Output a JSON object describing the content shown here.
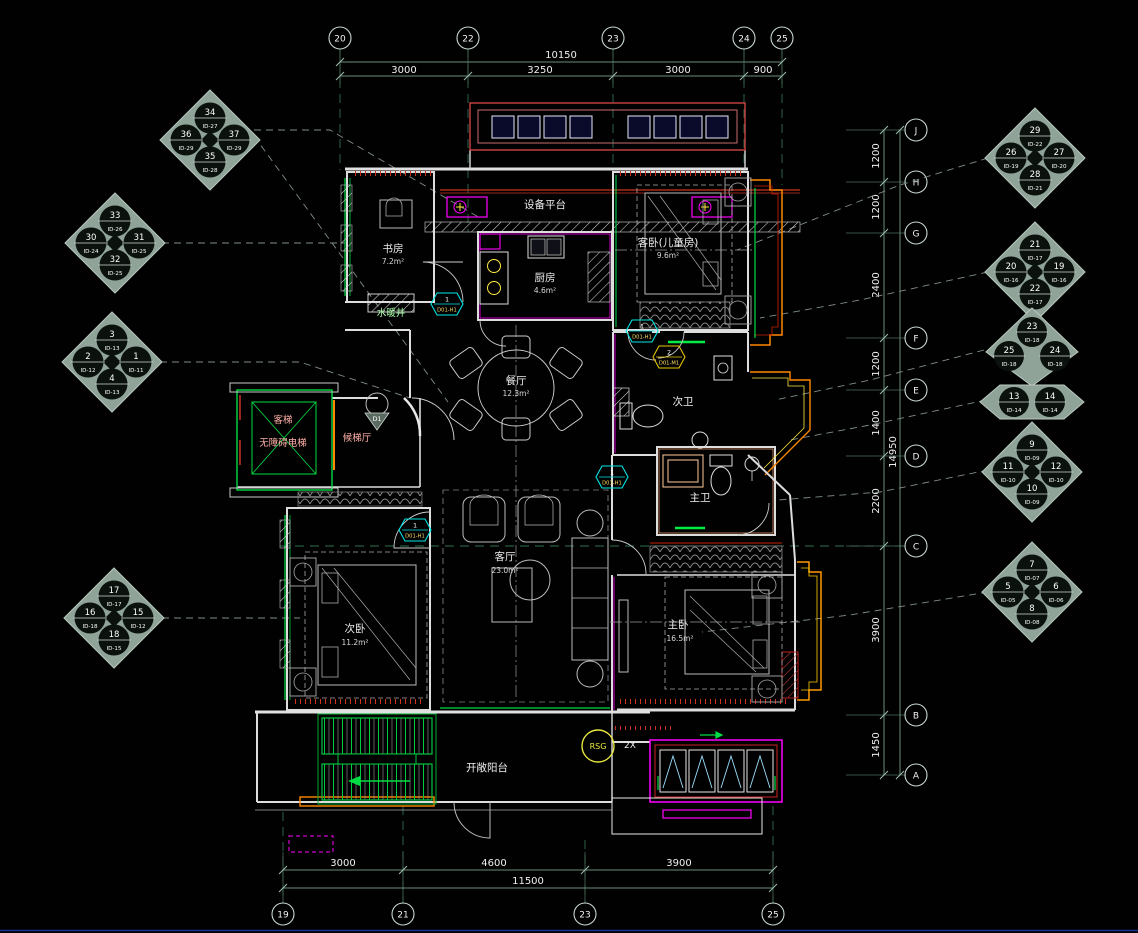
{
  "drawing": {
    "type": "CAD residential floor plan",
    "background": "#000000"
  },
  "colors": {
    "wall": "#e0e0e0",
    "green": "#00dd44",
    "magenta": "#ff00ff",
    "red": "#d03020",
    "orange": "#ff8800",
    "yellow": "#ffe840",
    "cyan": "#00e5e5",
    "dim": "#6a8f7c"
  },
  "grid": {
    "top": [
      "20",
      "22",
      "23",
      "24",
      "25"
    ],
    "bottom": [
      "19",
      "21",
      "23",
      "25"
    ],
    "right": [
      "J",
      "H",
      "G",
      "F",
      "E",
      "D",
      "C",
      "B",
      "A"
    ]
  },
  "dims": {
    "top": {
      "total": "10150",
      "seg": [
        "3000",
        "3250",
        "3000",
        "900"
      ]
    },
    "bottom": {
      "total": "11500",
      "seg": [
        "3000",
        "4600",
        "3900"
      ]
    },
    "right": {
      "total": "14950",
      "seg": [
        "1200",
        "1200",
        "2400",
        "1200",
        "1400",
        "2200",
        "3900",
        "1450"
      ]
    }
  },
  "rooms": {
    "study": {
      "name": "书房",
      "area": "7.2m²"
    },
    "equip": {
      "name": "设备平台"
    },
    "kitchen": {
      "name": "厨房",
      "area": "4.6m²"
    },
    "guest_bed": {
      "name": "客卧(儿童房)",
      "area": "9.6m²"
    },
    "shaft": {
      "name": "水暖井"
    },
    "dining": {
      "name": "餐厅",
      "area": "12.3m²"
    },
    "elevator": {
      "name": "客梯",
      "name2": "无障碍电梯"
    },
    "lobby": {
      "name": "候梯厅"
    },
    "bath2": {
      "name": "次卫"
    },
    "bath1": {
      "name": "主卫"
    },
    "bed2": {
      "name": "次卧",
      "area": "11.2m²"
    },
    "living": {
      "name": "客厅",
      "area": "23.0m²"
    },
    "bed1": {
      "name": "主卧",
      "area": "16.5m²"
    },
    "balcony": {
      "name": "开敞阳台"
    }
  },
  "tags": {
    "t1": {
      "num": "1",
      "code": "D01-H1"
    },
    "t2": {
      "num": "1",
      "code": "D01-H1"
    },
    "t3": {
      "num": "2",
      "code": "D01-M1"
    },
    "t4": {
      "num": "1",
      "code": "D01-H1"
    },
    "t5": {
      "num": "1",
      "code": "D01-H1"
    },
    "entry": {
      "label": "D1"
    },
    "rsg": {
      "label": "RSG"
    },
    "x2": {
      "label": "2X"
    }
  },
  "markers": {
    "m1": {
      "top": {
        "n": "34",
        "ref": "ID-27"
      },
      "left": {
        "n": "36",
        "ref": "ID-29"
      },
      "right": {
        "n": "37",
        "ref": "ID-29"
      },
      "bottom": {
        "n": "35",
        "ref": "ID-28"
      }
    },
    "m2": {
      "top": {
        "n": "33",
        "ref": "ID-26"
      },
      "left": {
        "n": "30",
        "ref": "ID-24"
      },
      "right": {
        "n": "31",
        "ref": "ID-25"
      },
      "bottom": {
        "n": "32",
        "ref": "ID-25"
      }
    },
    "m3": {
      "top": {
        "n": "3",
        "ref": "ID-13"
      },
      "left": {
        "n": "2",
        "ref": "ID-12"
      },
      "right": {
        "n": "1",
        "ref": "ID-11"
      },
      "bottom": {
        "n": "4",
        "ref": "ID-13"
      }
    },
    "m4": {
      "top": {
        "n": "17",
        "ref": "ID-17"
      },
      "left": {
        "n": "16",
        "ref": "ID-18"
      },
      "right": {
        "n": "15",
        "ref": "ID-12"
      },
      "bottom": {
        "n": "18",
        "ref": "ID-15"
      }
    },
    "m5": {
      "top": {
        "n": "29",
        "ref": "ID-22"
      },
      "left": {
        "n": "26",
        "ref": "ID-19"
      },
      "right": {
        "n": "27",
        "ref": "ID-20"
      },
      "bottom": {
        "n": "28",
        "ref": "ID-21"
      }
    },
    "m6": {
      "top": {
        "n": "21",
        "ref": "ID-17"
      },
      "left": {
        "n": "20",
        "ref": "ID-16"
      },
      "right": {
        "n": "19",
        "ref": "ID-16"
      },
      "bottom": {
        "n": "22",
        "ref": "ID-17"
      }
    },
    "m7": {
      "top": {
        "n": "23",
        "ref": "ID-18"
      },
      "left": {
        "n": "25",
        "ref": "ID-18"
      },
      "right": {
        "n": "24",
        "ref": "ID-18"
      }
    },
    "m8": {
      "left": {
        "n": "13",
        "ref": "ID-14"
      },
      "right": {
        "n": "14",
        "ref": "ID-14"
      }
    },
    "m9": {
      "top": {
        "n": "9",
        "ref": "ID-09"
      },
      "left": {
        "n": "11",
        "ref": "ID-10"
      },
      "right": {
        "n": "12",
        "ref": "ID-10"
      },
      "bottom": {
        "n": "10",
        "ref": "ID-09"
      }
    },
    "m10": {
      "top": {
        "n": "7",
        "ref": "ID-07"
      },
      "left": {
        "n": "5",
        "ref": "ID-05"
      },
      "right": {
        "n": "6",
        "ref": "ID-06"
      },
      "bottom": {
        "n": "8",
        "ref": "ID-08"
      }
    }
  }
}
